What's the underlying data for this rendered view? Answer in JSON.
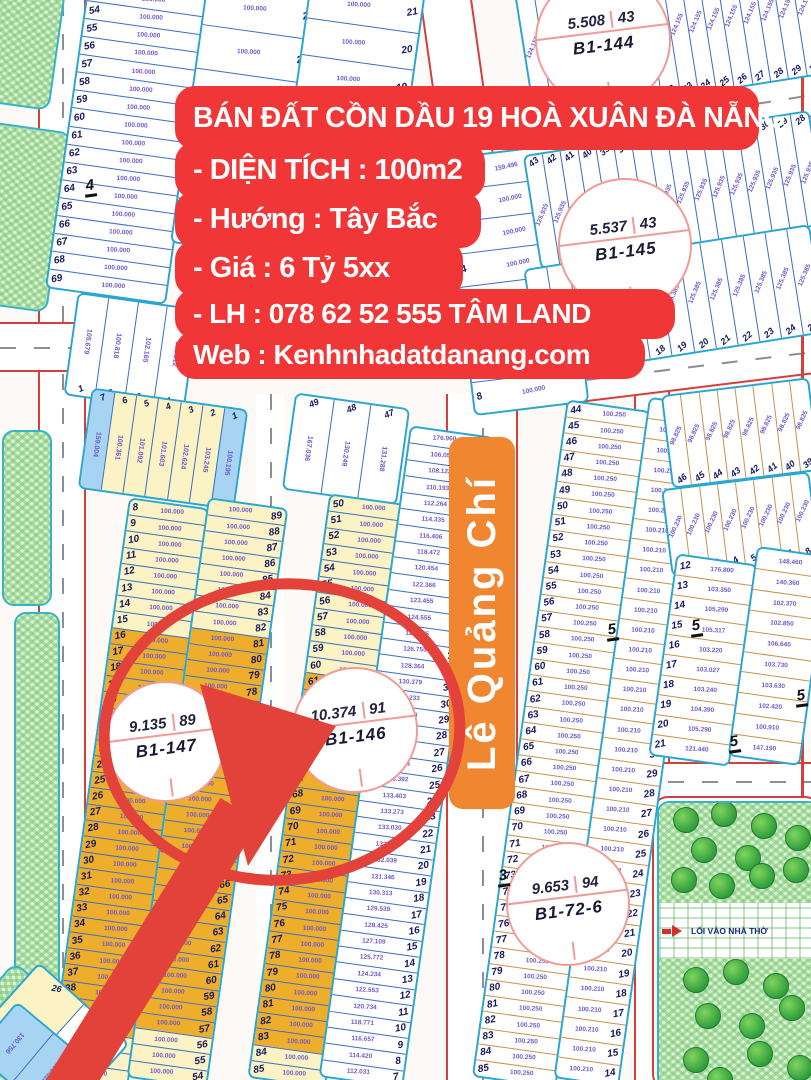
{
  "banner": {
    "title": "BÁN ĐẤT CỒN DẦU 19 HOÀ XUÂN ĐÀ NẴNG",
    "lines": [
      "- DIỆN TÍCH : 100m2",
      "- Hướng : Tây Bắc",
      "- Giá : 6 Tỷ 5xx",
      "- LH : 078 62 52 555 TÂM LAND",
      "Web : Kenhnhadatdanang.com"
    ]
  },
  "street": {
    "name": "Lê Quảng Chí"
  },
  "park": {
    "entrance": "LỐI VÀO NHÀ THỜ",
    "trees": [
      [
        26,
        16
      ],
      [
        64,
        10
      ],
      [
        104,
        22
      ],
      [
        138,
        34
      ],
      [
        44,
        46
      ],
      [
        88,
        54
      ],
      [
        24,
        76
      ],
      [
        62,
        82
      ],
      [
        102,
        72
      ],
      [
        136,
        66
      ],
      [
        36,
        176
      ],
      [
        76,
        168
      ],
      [
        116,
        182
      ],
      [
        48,
        212
      ],
      [
        92,
        222
      ],
      [
        132,
        204
      ],
      [
        36,
        256
      ],
      [
        100,
        250
      ],
      [
        140,
        264
      ],
      [
        60,
        276
      ]
    ]
  },
  "colors": {
    "accent_red": "#f13637",
    "street_orange": "#f0862f",
    "highlight_red": "#e2423a",
    "plot_colors": {
      "w": "#ffffff",
      "y": "#fbf3c4",
      "o": "#eeae2b",
      "b": "#a6d4f2"
    },
    "sep_colors": {
      "blue": "#3a6fc0",
      "tan": "#c9924e"
    }
  },
  "circles": [
    {
      "id": "B1-144",
      "area": "5.508",
      "lots": "43",
      "x": 535,
      "y": -28,
      "d": 132
    },
    {
      "id": "B1-145",
      "area": "5.537",
      "lots": "43",
      "x": 558,
      "y": 178,
      "d": 130
    },
    {
      "id": "B1-146",
      "area": "10.374",
      "lots": "91",
      "x": 292,
      "y": 667,
      "d": 122
    },
    {
      "id": "B1-147",
      "area": "9.135",
      "lots": "89",
      "x": 105,
      "y": 681,
      "d": 117
    },
    {
      "id": "B1-72-6",
      "area": "9.653",
      "lots": "94",
      "x": 506,
      "y": 842,
      "d": 120
    }
  ],
  "marks": [
    {
      "t": "4",
      "x": 84,
      "y": 178
    },
    {
      "t": "5",
      "x": 606,
      "y": 622
    },
    {
      "t": "5",
      "x": 690,
      "y": 618
    },
    {
      "t": "5",
      "x": 795,
      "y": 688
    },
    {
      "t": "5",
      "x": 728,
      "y": 734
    },
    {
      "t": "3",
      "x": 497,
      "y": 868
    }
  ],
  "map": {
    "blocks": [
      {
        "id": "tl-left",
        "k": "h",
        "x": 66,
        "y": -12,
        "w": 118,
        "h": 306,
        "r": 8,
        "ns": "l",
        "sep": "blue",
        "items": [
          {
            "seq": [
              53,
              69
            ],
            "v": "100.000",
            "c": "w"
          }
        ]
      },
      {
        "id": "tl-right",
        "k": "h",
        "x": 188,
        "y": -14,
        "w": 112,
        "h": 262,
        "r": 8,
        "ns": "r",
        "sep": "blue",
        "items": [
          {
            "seq": [
              24,
              19
            ],
            "v": "100.000",
            "c": "w"
          }
        ]
      },
      {
        "id": "tm-col",
        "k": "h",
        "x": 302,
        "y": -14,
        "w": 112,
        "h": 112,
        "r": 8,
        "ns": "r",
        "sep": "blue",
        "items": [
          {
            "seq": [
              21,
              19
            ],
            "v": "100.000",
            "c": "w"
          }
        ]
      },
      {
        "id": "tl-row",
        "k": "v",
        "x": 70,
        "y": 300,
        "w": 118,
        "h": 100,
        "r": 8,
        "ns": "b",
        "sep": "blue",
        "vv": true,
        "items": [
          {
            "n": "1",
            "v": "105.679",
            "c": "w"
          },
          {
            "n": "2",
            "v": "100.818",
            "c": "w"
          },
          {
            "n": "3",
            "v": "102.165",
            "c": "w"
          },
          {
            "n": "4",
            "v": "103.512",
            "c": "w"
          }
        ]
      },
      {
        "id": "tc-col",
        "k": "h",
        "x": 458,
        "y": 150,
        "w": 112,
        "h": 256,
        "r": -7,
        "ns": "l",
        "sep": "blue",
        "items": [
          {
            "n": "1",
            "v": "159.496",
            "c": "w"
          },
          {
            "seq": [
              2,
              8
            ],
            "v": "100.000",
            "c": "w"
          }
        ]
      },
      {
        "id": "tr-fan1",
        "k": "v",
        "x": 522,
        "y": -36,
        "w": 292,
        "h": 130,
        "r": -9,
        "ns": "b",
        "sep": "blue",
        "items": [
          {
            "seq": [
              15,
              30
            ],
            "v": "124.155",
            "c": "w"
          }
        ]
      },
      {
        "id": "tr-fan2",
        "k": "v",
        "x": 530,
        "y": 132,
        "w": 286,
        "h": 112,
        "r": -9,
        "ns": "t",
        "sep": "blue",
        "items": [
          {
            "seq": [
              43,
              28
            ],
            "v": "125.935",
            "c": "w"
          }
        ]
      },
      {
        "id": "tr-fan3",
        "k": "v",
        "x": 530,
        "y": 246,
        "w": 286,
        "h": 106,
        "r": -9,
        "ns": "b",
        "sep": "blue",
        "items": [
          {
            "seq": [
              13,
              25
            ],
            "v": "125.385",
            "c": "w"
          }
        ]
      },
      {
        "id": "L-head",
        "k": "v",
        "x": 84,
        "y": 398,
        "w": 154,
        "h": 98,
        "r": 8,
        "ns": "t",
        "sep": "blue",
        "vv": true,
        "items": [
          {
            "n": "7",
            "v": "159.004",
            "c": "b"
          },
          {
            "n": "6",
            "v": "100.361",
            "c": "y"
          },
          {
            "n": "5",
            "v": "101.092",
            "c": "y"
          },
          {
            "n": "4",
            "v": "101.603",
            "c": "y"
          },
          {
            "n": "3",
            "v": "102.624",
            "c": "y"
          },
          {
            "n": "2",
            "v": "103.245",
            "c": "y"
          },
          {
            "n": "1",
            "v": "100.195",
            "c": "b"
          }
        ]
      },
      {
        "id": "L-a",
        "k": "h",
        "x": 88,
        "y": 500,
        "w": 77,
        "h": 582,
        "r": 8,
        "ns": "l",
        "sep": "blue",
        "items": [
          {
            "seq": [
              8,
              15
            ],
            "v": "100.000",
            "c": "y"
          },
          {
            "seq": [
              16,
              40
            ],
            "v": "100.000",
            "c": "o"
          },
          {
            "seq": [
              41,
              43
            ],
            "v": "100.000",
            "c": "y"
          }
        ]
      },
      {
        "id": "L-b",
        "k": "h",
        "x": 167,
        "y": 500,
        "w": 77,
        "h": 582,
        "r": 8,
        "ns": "r",
        "sep": "blue",
        "items": [
          {
            "seq": [
              89,
              82
            ],
            "v": "100.000",
            "c": "y"
          },
          {
            "seq": [
              81,
              57
            ],
            "v": "100.000",
            "c": "o"
          },
          {
            "seq": [
              56,
              54
            ],
            "v": "100.000",
            "c": "y"
          }
        ]
      },
      {
        "id": "M-head",
        "k": "v",
        "x": 288,
        "y": 400,
        "w": 112,
        "h": 94,
        "r": 8,
        "ns": "t",
        "sep": "blue",
        "vv": true,
        "items": [
          {
            "n": "49",
            "v": "167.036",
            "c": "w"
          },
          {
            "n": "48",
            "v": "130.249",
            "c": "w"
          },
          {
            "n": "47",
            "v": "131.288",
            "c": "w"
          }
        ]
      },
      {
        "id": "M-a",
        "k": "h",
        "x": 288,
        "y": 496,
        "w": 75,
        "h": 586,
        "r": 8,
        "ns": "l",
        "sep": "blue",
        "items": [
          {
            "seq": [
              50,
              60
            ],
            "v": "100.000",
            "c": "y"
          },
          {
            "seq": [
              61,
              83
            ],
            "v": "100.000",
            "c": "o"
          },
          {
            "seq": [
              84,
              85
            ],
            "v": "100.000",
            "c": "y"
          }
        ]
      },
      {
        "id": "M-b",
        "k": "h",
        "x": 364,
        "y": 428,
        "w": 81,
        "h": 654,
        "r": 8,
        "ns": "r",
        "sep": "blue",
        "items": [
          {
            "n": "46",
            "v": "176.960",
            "c": "w"
          },
          {
            "n": "45",
            "v": "106.051",
            "c": "w"
          },
          {
            "n": "44",
            "v": "108.122",
            "c": "w"
          },
          {
            "n": "43",
            "v": "110.193",
            "c": "w"
          },
          {
            "n": "42",
            "v": "112.264",
            "c": "w"
          },
          {
            "n": "41",
            "v": "114.335",
            "c": "w"
          },
          {
            "n": "40",
            "v": "116.406",
            "c": "w"
          },
          {
            "n": "39",
            "v": "118.472",
            "c": "w"
          },
          {
            "n": "38",
            "v": "120.454",
            "c": "w"
          },
          {
            "n": "37",
            "v": "122.366",
            "c": "w"
          },
          {
            "n": "36",
            "v": "123.455",
            "c": "w"
          },
          {
            "n": "35",
            "v": "124.555",
            "c": "w"
          },
          {
            "n": "34",
            "v": "125.655",
            "c": "w"
          },
          {
            "n": "33",
            "v": "126.755",
            "c": "w"
          },
          {
            "n": "32",
            "v": "128.364",
            "c": "w"
          },
          {
            "n": "31",
            "v": "130.379",
            "c": "w"
          },
          {
            "n": "30",
            "v": "131.233",
            "c": "w"
          },
          {
            "n": "29",
            "v": "131.948",
            "c": "w"
          },
          {
            "n": "28",
            "v": "132.616",
            "c": "w"
          },
          {
            "n": "27",
            "v": "132.950",
            "c": "w"
          },
          {
            "n": "26",
            "v": "133.241",
            "c": "w"
          },
          {
            "n": "25",
            "v": "133.392",
            "c": "w"
          },
          {
            "n": "24",
            "v": "133.403",
            "c": "w"
          },
          {
            "n": "23",
            "v": "133.273",
            "c": "w"
          },
          {
            "n": "22",
            "v": "133.030",
            "c": "w"
          },
          {
            "n": "21",
            "v": "132.700",
            "c": "w"
          },
          {
            "n": "20",
            "v": "132.039",
            "c": "w"
          },
          {
            "n": "19",
            "v": "131.346",
            "c": "w"
          },
          {
            "n": "18",
            "v": "130.313",
            "c": "w"
          },
          {
            "n": "17",
            "v": "129.539",
            "c": "w"
          },
          {
            "n": "16",
            "v": "128.425",
            "c": "w"
          },
          {
            "n": "15",
            "v": "127.109",
            "c": "w"
          },
          {
            "n": "14",
            "v": "125.772",
            "c": "w"
          },
          {
            "n": "13",
            "v": "124.234",
            "c": "w"
          },
          {
            "n": "12",
            "v": "122.553",
            "c": "w"
          },
          {
            "n": "11",
            "v": "120.734",
            "c": "w"
          },
          {
            "n": "10",
            "v": "118.771",
            "c": "w"
          },
          {
            "n": "9",
            "v": "116.657",
            "c": "w"
          },
          {
            "n": "8",
            "v": "114.420",
            "c": "w"
          },
          {
            "n": "7",
            "v": "112.031",
            "c": "w"
          }
        ]
      },
      {
        "id": "R1-a",
        "k": "h",
        "x": 519,
        "y": 402,
        "w": 81,
        "h": 680,
        "r": 8,
        "ns": "l",
        "sep": "tan",
        "items": [
          {
            "seq": [
              44,
              85
            ],
            "v": "100.250",
            "c": "w"
          }
        ]
      },
      {
        "id": "R1-b",
        "k": "h",
        "x": 601,
        "y": 398,
        "w": 62,
        "h": 684,
        "r": 8,
        "ns": "r",
        "sep": "tan",
        "items": [
          {
            "seq": [
              47,
              14
            ],
            "v": "100.210",
            "c": "w"
          }
        ]
      },
      {
        "id": "R2-a",
        "k": "v",
        "x": 666,
        "y": 386,
        "w": 145,
        "h": 90,
        "r": -7,
        "ns": "b",
        "sep": "tan",
        "items": [
          {
            "seq": [
              46,
              39
            ],
            "v": "98.825",
            "c": "w"
          }
        ]
      },
      {
        "id": "R2-b",
        "k": "v",
        "x": 666,
        "y": 480,
        "w": 145,
        "h": 84,
        "r": -7,
        "ns": "b",
        "sep": "tan",
        "items": [
          {
            "seq": [
              1,
              8
            ],
            "v": "100.230",
            "c": "w"
          }
        ]
      },
      {
        "id": "R3-a",
        "k": "h",
        "x": 662,
        "y": 558,
        "w": 78,
        "h": 200,
        "r": 8,
        "ns": "l",
        "sep": "tan",
        "items": [
          {
            "n": "12",
            "v": "176.800",
            "c": "w"
          },
          {
            "n": "13",
            "v": "103.350",
            "c": "w"
          },
          {
            "n": "14",
            "v": "105.290",
            "c": "w"
          },
          {
            "n": "15",
            "v": "105.317",
            "c": "w"
          },
          {
            "n": "16",
            "v": "103.220",
            "c": "w"
          },
          {
            "n": "17",
            "v": "103.027",
            "c": "w"
          },
          {
            "n": "18",
            "v": "103.240",
            "c": "w"
          },
          {
            "n": "19",
            "v": "104.390",
            "c": "w"
          },
          {
            "n": "20",
            "v": "105.290",
            "c": "w"
          },
          {
            "n": "21",
            "v": "121.440",
            "c": "w"
          }
        ]
      },
      {
        "id": "R3-b",
        "k": "h",
        "x": 742,
        "y": 550,
        "w": 69,
        "h": 208,
        "r": 8,
        "ns": "r",
        "sep": "tan",
        "items": [
          {
            "n": "",
            "v": "148.460",
            "c": "w"
          },
          {
            "n": "",
            "v": "140.360",
            "c": "w"
          },
          {
            "n": "",
            "v": "102.370",
            "c": "w"
          },
          {
            "n": "",
            "v": "102.850",
            "c": "w"
          },
          {
            "n": "",
            "v": "106.640",
            "c": "w"
          },
          {
            "n": "",
            "v": "103.730",
            "c": "w"
          },
          {
            "n": "",
            "v": "103.630",
            "c": "w"
          },
          {
            "n": "",
            "v": "102.420",
            "c": "w"
          },
          {
            "n": "",
            "v": "100.910",
            "c": "w"
          },
          {
            "n": "",
            "v": "147.190",
            "c": "w"
          }
        ]
      },
      {
        "id": "bl-corner",
        "k": "v",
        "x": -10,
        "y": 990,
        "w": 118,
        "h": 96,
        "r": 42,
        "ns": "t",
        "sep": "blue",
        "items": [
          {
            "n": "26",
            "v": "",
            "c": "y"
          },
          {
            "n": "25",
            "v": "",
            "c": "w"
          }
        ]
      },
      {
        "id": "bl-blue",
        "k": "v",
        "x": -16,
        "y": 1024,
        "w": 92,
        "h": 64,
        "r": 40,
        "ns": "t",
        "sep": "blue",
        "vv": true,
        "items": [
          {
            "n": "",
            "v": "130.756",
            "c": "b"
          },
          {
            "n": "",
            "v": "130.326",
            "c": "b"
          }
        ]
      }
    ]
  }
}
